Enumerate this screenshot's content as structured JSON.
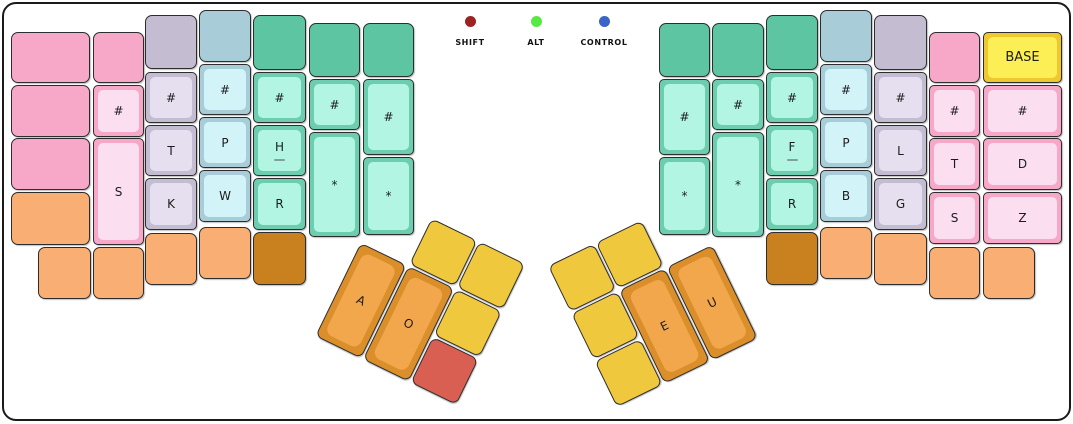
{
  "app": {
    "view": "keyboard-layout",
    "active_layer": "BASE"
  },
  "legend": {
    "items": [
      {
        "id": "shift",
        "label": "SHIFT",
        "color": "#9b2423"
      },
      {
        "id": "alt",
        "label": "ALT",
        "color": "#57e843"
      },
      {
        "id": "control",
        "label": "CONTROL",
        "color": "#3a64c6"
      }
    ]
  },
  "palettes": {
    "pink": {
      "base": "#f7a8c8",
      "cap": "#fbdff0"
    },
    "gray": {
      "base": "#c4bdd1",
      "cap": "#e5dff0"
    },
    "blue": {
      "base": "#a8cdd9",
      "cap": "#d2f4f8"
    },
    "greenDark": {
      "base": "#5ec5a3"
    },
    "green": {
      "base": "#6cceae",
      "cap": "#b2f5e3"
    },
    "orange": {
      "base": "#f9ae74"
    },
    "orangeDark": {
      "base": "#c8811e"
    },
    "thumbOrange": {
      "base": "#da8f2b",
      "cap": "#f3a74d"
    },
    "yellow": {
      "base": "#f0c83e"
    },
    "red": {
      "base": "#d95f52"
    },
    "layerYellow": {
      "base": "#efc72e",
      "cap": "#fcee55"
    }
  },
  "keyboard": {
    "left_main": [
      {
        "x": 11,
        "y": 32,
        "w": 79,
        "h": 51,
        "palette": "pink",
        "style": "flat"
      },
      {
        "x": 11,
        "y": 85,
        "w": 79,
        "h": 52,
        "palette": "pink",
        "style": "flat"
      },
      {
        "x": 11,
        "y": 138,
        "w": 79,
        "h": 52,
        "palette": "pink",
        "style": "flat"
      },
      {
        "x": 11,
        "y": 192,
        "w": 79,
        "h": 53,
        "palette": "orange",
        "style": "flat"
      },
      {
        "x": 38,
        "y": 247,
        "w": 53,
        "h": 52,
        "palette": "orange",
        "style": "flat"
      },
      {
        "x": 93,
        "y": 32,
        "w": 51,
        "h": 51,
        "palette": "pink",
        "style": "flat"
      },
      {
        "x": 93,
        "y": 85,
        "w": 51,
        "h": 52,
        "palette": "pink",
        "style": "cap",
        "label": "#"
      },
      {
        "x": 93,
        "y": 138,
        "w": 51,
        "h": 107,
        "palette": "pink",
        "style": "cap",
        "label": "S"
      },
      {
        "x": 93,
        "y": 247,
        "w": 51,
        "h": 52,
        "palette": "orange",
        "style": "flat"
      },
      {
        "x": 145,
        "y": 15,
        "w": 52,
        "h": 54,
        "palette": "gray",
        "style": "flat"
      },
      {
        "x": 145,
        "y": 72,
        "w": 52,
        "h": 51,
        "palette": "gray",
        "style": "cap",
        "label": "#"
      },
      {
        "x": 145,
        "y": 125,
        "w": 52,
        "h": 51,
        "palette": "gray",
        "style": "cap",
        "label": "T"
      },
      {
        "x": 145,
        "y": 178,
        "w": 52,
        "h": 52,
        "palette": "gray",
        "style": "cap",
        "label": "K"
      },
      {
        "x": 145,
        "y": 233,
        "w": 52,
        "h": 52,
        "palette": "orange",
        "style": "flat"
      },
      {
        "x": 199,
        "y": 10,
        "w": 52,
        "h": 52,
        "palette": "blue",
        "style": "flat"
      },
      {
        "x": 199,
        "y": 64,
        "w": 52,
        "h": 51,
        "palette": "blue",
        "style": "cap",
        "label": "#"
      },
      {
        "x": 199,
        "y": 117,
        "w": 52,
        "h": 51,
        "palette": "blue",
        "style": "cap",
        "label": "P"
      },
      {
        "x": 199,
        "y": 170,
        "w": 52,
        "h": 52,
        "palette": "blue",
        "style": "cap",
        "label": "W"
      },
      {
        "x": 199,
        "y": 227,
        "w": 52,
        "h": 52,
        "palette": "orange",
        "style": "flat"
      },
      {
        "x": 253,
        "y": 15,
        "w": 53,
        "h": 55,
        "palette": "greenDark",
        "style": "flat"
      },
      {
        "x": 253,
        "y": 72,
        "w": 53,
        "h": 51,
        "palette": "green",
        "style": "cap",
        "label": "#"
      },
      {
        "x": 253,
        "y": 125,
        "w": 53,
        "h": 51,
        "palette": "green",
        "style": "cap",
        "label": "H",
        "sub": true
      },
      {
        "x": 253,
        "y": 178,
        "w": 53,
        "h": 52,
        "palette": "green",
        "style": "cap",
        "label": "R"
      },
      {
        "x": 253,
        "y": 232,
        "w": 53,
        "h": 53,
        "palette": "orangeDark",
        "style": "flat"
      },
      {
        "x": 309,
        "y": 23,
        "w": 51,
        "h": 54,
        "palette": "greenDark",
        "style": "flat"
      },
      {
        "x": 309,
        "y": 79,
        "w": 51,
        "h": 51,
        "palette": "green",
        "style": "cap",
        "label": "#"
      },
      {
        "x": 309,
        "y": 132,
        "w": 51,
        "h": 105,
        "palette": "green",
        "style": "cap",
        "label": "*"
      },
      {
        "x": 363,
        "y": 23,
        "w": 51,
        "h": 54,
        "palette": "greenDark",
        "style": "flat"
      },
      {
        "x": 363,
        "y": 79,
        "w": 51,
        "h": 76,
        "palette": "green",
        "style": "cap",
        "label": "#"
      },
      {
        "x": 363,
        "y": 157,
        "w": 51,
        "h": 78,
        "palette": "green",
        "style": "cap",
        "label": "*"
      }
    ],
    "right_main": [
      {
        "x": 659,
        "y": 23,
        "w": 51,
        "h": 54,
        "palette": "greenDark",
        "style": "flat"
      },
      {
        "x": 659,
        "y": 79,
        "w": 51,
        "h": 76,
        "palette": "green",
        "style": "cap",
        "label": "#"
      },
      {
        "x": 659,
        "y": 157,
        "w": 51,
        "h": 78,
        "palette": "green",
        "style": "cap",
        "label": "*"
      },
      {
        "x": 712,
        "y": 23,
        "w": 52,
        "h": 54,
        "palette": "greenDark",
        "style": "flat"
      },
      {
        "x": 712,
        "y": 79,
        "w": 52,
        "h": 51,
        "palette": "green",
        "style": "cap",
        "label": "#"
      },
      {
        "x": 712,
        "y": 132,
        "w": 52,
        "h": 105,
        "palette": "green",
        "style": "cap",
        "label": "*"
      },
      {
        "x": 766,
        "y": 15,
        "w": 52,
        "h": 55,
        "palette": "greenDark",
        "style": "flat"
      },
      {
        "x": 766,
        "y": 72,
        "w": 52,
        "h": 51,
        "palette": "green",
        "style": "cap",
        "label": "#"
      },
      {
        "x": 766,
        "y": 125,
        "w": 52,
        "h": 51,
        "palette": "green",
        "style": "cap",
        "label": "F",
        "sub": true
      },
      {
        "x": 766,
        "y": 178,
        "w": 52,
        "h": 52,
        "palette": "green",
        "style": "cap",
        "label": "R"
      },
      {
        "x": 766,
        "y": 232,
        "w": 52,
        "h": 53,
        "palette": "orangeDark",
        "style": "flat"
      },
      {
        "x": 820,
        "y": 10,
        "w": 52,
        "h": 52,
        "palette": "blue",
        "style": "flat"
      },
      {
        "x": 820,
        "y": 64,
        "w": 52,
        "h": 51,
        "palette": "blue",
        "style": "cap",
        "label": "#"
      },
      {
        "x": 820,
        "y": 117,
        "w": 52,
        "h": 51,
        "palette": "blue",
        "style": "cap",
        "label": "P"
      },
      {
        "x": 820,
        "y": 170,
        "w": 52,
        "h": 52,
        "palette": "blue",
        "style": "cap",
        "label": "B"
      },
      {
        "x": 820,
        "y": 227,
        "w": 52,
        "h": 52,
        "palette": "orange",
        "style": "flat"
      },
      {
        "x": 874,
        "y": 15,
        "w": 53,
        "h": 55,
        "palette": "gray",
        "style": "flat"
      },
      {
        "x": 874,
        "y": 72,
        "w": 53,
        "h": 51,
        "palette": "gray",
        "style": "cap",
        "label": "#"
      },
      {
        "x": 874,
        "y": 125,
        "w": 53,
        "h": 51,
        "palette": "gray",
        "style": "cap",
        "label": "L"
      },
      {
        "x": 874,
        "y": 178,
        "w": 53,
        "h": 52,
        "palette": "gray",
        "style": "cap",
        "label": "G"
      },
      {
        "x": 874,
        "y": 233,
        "w": 53,
        "h": 52,
        "palette": "orange",
        "style": "flat"
      },
      {
        "x": 929,
        "y": 32,
        "w": 51,
        "h": 51,
        "palette": "pink",
        "style": "flat"
      },
      {
        "x": 929,
        "y": 85,
        "w": 51,
        "h": 52,
        "palette": "pink",
        "style": "cap",
        "label": "#"
      },
      {
        "x": 929,
        "y": 138,
        "w": 51,
        "h": 52,
        "palette": "pink",
        "style": "cap",
        "label": "T"
      },
      {
        "x": 929,
        "y": 192,
        "w": 51,
        "h": 52,
        "palette": "pink",
        "style": "cap",
        "label": "S"
      },
      {
        "x": 929,
        "y": 247,
        "w": 51,
        "h": 52,
        "palette": "orange",
        "style": "flat"
      },
      {
        "x": 983,
        "y": 32,
        "w": 79,
        "h": 51,
        "palette": "layerYellow",
        "style": "cap",
        "label": "BASE",
        "name": "key-layer-base"
      },
      {
        "x": 983,
        "y": 85,
        "w": 79,
        "h": 52,
        "palette": "pink",
        "style": "cap",
        "label": "#"
      },
      {
        "x": 983,
        "y": 138,
        "w": 79,
        "h": 52,
        "palette": "pink",
        "style": "cap",
        "label": "D"
      },
      {
        "x": 983,
        "y": 192,
        "w": 79,
        "h": 52,
        "palette": "pink",
        "style": "cap",
        "label": "Z"
      },
      {
        "x": 983,
        "y": 247,
        "w": 52,
        "h": 52,
        "palette": "orange",
        "style": "flat"
      }
    ],
    "left_thumb": {
      "origin_x": 384,
      "origin_y": 195,
      "rotation": 26,
      "keys": [
        {
          "x": 53,
          "y": 0,
          "w": 51,
          "h": 51,
          "palette": "yellow",
          "style": "flat"
        },
        {
          "x": 106,
          "y": 0,
          "w": 51,
          "h": 51,
          "palette": "yellow",
          "style": "flat"
        },
        {
          "x": 0,
          "y": 53,
          "w": 51,
          "h": 104,
          "palette": "thumbOrange",
          "style": "bigcap",
          "label": "A"
        },
        {
          "x": 53,
          "y": 53,
          "w": 51,
          "h": 104,
          "palette": "thumbOrange",
          "style": "bigcap",
          "label": "O"
        },
        {
          "x": 106,
          "y": 53,
          "w": 51,
          "h": 51,
          "palette": "yellow",
          "style": "flat"
        },
        {
          "x": 106,
          "y": 106,
          "w": 51,
          "h": 51,
          "palette": "red",
          "style": "flat"
        }
      ]
    },
    "right_thumb": {
      "origin_x": 548,
      "origin_y": 266,
      "rotation": -26,
      "keys": [
        {
          "x": 0,
          "y": 0,
          "w": 51,
          "h": 51,
          "palette": "yellow",
          "style": "flat"
        },
        {
          "x": 53,
          "y": 0,
          "w": 51,
          "h": 51,
          "palette": "yellow",
          "style": "flat"
        },
        {
          "x": 0,
          "y": 53,
          "w": 51,
          "h": 51,
          "palette": "yellow",
          "style": "flat"
        },
        {
          "x": 53,
          "y": 53,
          "w": 51,
          "h": 104,
          "palette": "thumbOrange",
          "style": "bigcap",
          "label": "E"
        },
        {
          "x": 106,
          "y": 53,
          "w": 51,
          "h": 104,
          "palette": "thumbOrange",
          "style": "bigcap",
          "label": "U"
        },
        {
          "x": 0,
          "y": 106,
          "w": 51,
          "h": 51,
          "palette": "yellow",
          "style": "flat"
        }
      ]
    }
  }
}
